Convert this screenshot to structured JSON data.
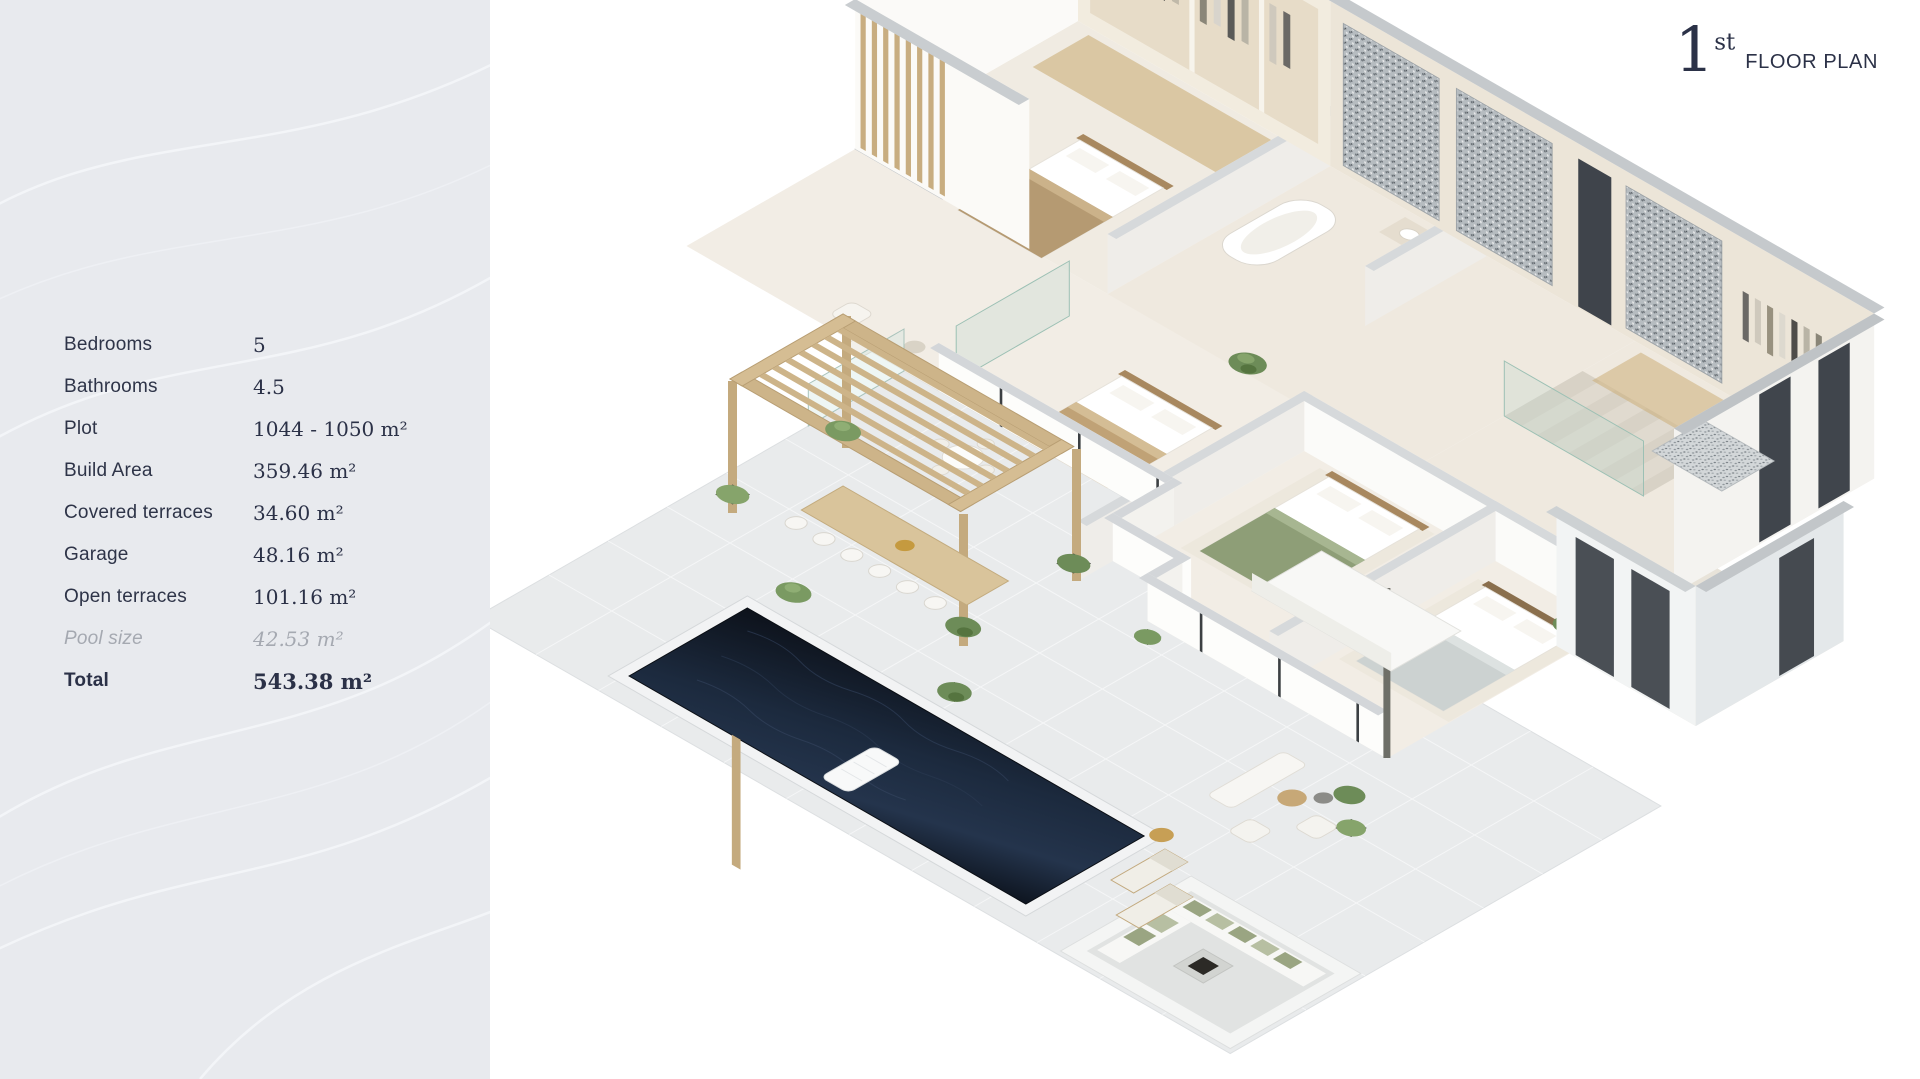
{
  "title": {
    "number": "1",
    "ordinal": "st",
    "label": "FLOOR PLAN"
  },
  "sidebar": {
    "specs": [
      {
        "label": "Bedrooms",
        "value": "5"
      },
      {
        "label": "Bathrooms",
        "value": "4.5"
      },
      {
        "label": "Plot",
        "value": "1044 - 1050 m²"
      },
      {
        "label": "Build Area",
        "value": "359.46 m²"
      },
      {
        "label": "Covered terraces",
        "value": "34.60 m²"
      },
      {
        "label": "Garage",
        "value": "48.16 m²"
      },
      {
        "label": "Open terraces",
        "value": "101.16 m²"
      },
      {
        "label": "Pool size",
        "value": "42.53 m²"
      },
      {
        "label": "Total",
        "value": "543.38 m²"
      }
    ]
  },
  "colors": {
    "accent_navy": "#2b3147",
    "sidebar_background": "#e8eaee",
    "muted_text": "#a5a9b1",
    "pool_water": "#131a26",
    "wood": "#c9b189",
    "roof_gray": "#c5c9cc"
  }
}
